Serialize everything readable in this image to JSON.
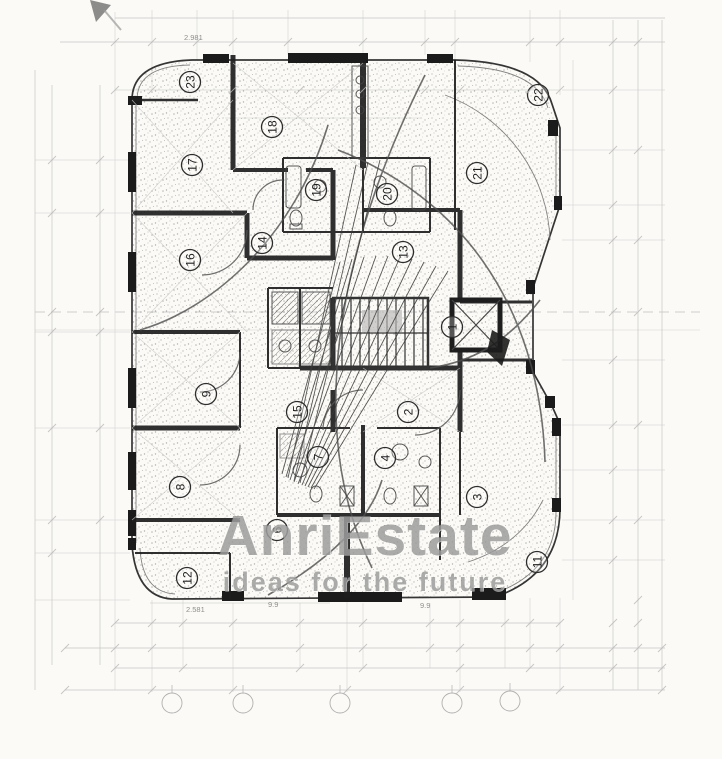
{
  "watermark": {
    "brand": "AnriEstate",
    "tagline": "ideas for the future"
  },
  "room_markers": [
    {
      "n": "1",
      "x": 452,
      "y": 327
    },
    {
      "n": "2",
      "x": 408,
      "y": 412
    },
    {
      "n": "3",
      "x": 477,
      "y": 497
    },
    {
      "n": "4",
      "x": 385,
      "y": 458
    },
    {
      "n": "6",
      "x": 277,
      "y": 530
    },
    {
      "n": "7",
      "x": 318,
      "y": 457
    },
    {
      "n": "8",
      "x": 180,
      "y": 487
    },
    {
      "n": "9",
      "x": 206,
      "y": 394
    },
    {
      "n": "11",
      "x": 537,
      "y": 562
    },
    {
      "n": "12",
      "x": 187,
      "y": 578
    },
    {
      "n": "13",
      "x": 403,
      "y": 252
    },
    {
      "n": "14",
      "x": 262,
      "y": 243
    },
    {
      "n": "15",
      "x": 297,
      "y": 412
    },
    {
      "n": "16",
      "x": 190,
      "y": 260
    },
    {
      "n": "17",
      "x": 192,
      "y": 165
    },
    {
      "n": "18",
      "x": 272,
      "y": 127
    },
    {
      "n": "19",
      "x": 316,
      "y": 190
    },
    {
      "n": "20",
      "x": 387,
      "y": 194
    },
    {
      "n": "21",
      "x": 477,
      "y": 173
    },
    {
      "n": "22",
      "x": 538,
      "y": 95
    },
    {
      "n": "23",
      "x": 190,
      "y": 82
    }
  ],
  "dimension_labels": [
    {
      "text": "2.981",
      "x": 184,
      "y": 40
    },
    {
      "text": "2.581",
      "x": 186,
      "y": 612
    },
    {
      "text": "9.9",
      "x": 268,
      "y": 607
    },
    {
      "text": "9.9",
      "x": 420,
      "y": 608
    }
  ],
  "axis_bubbles": [
    {
      "x": 172,
      "y": 703
    },
    {
      "x": 243,
      "y": 703
    },
    {
      "x": 340,
      "y": 703
    },
    {
      "x": 452,
      "y": 703
    },
    {
      "x": 510,
      "y": 701
    }
  ],
  "colors": {
    "paper": "#fbfaf6",
    "ink": "#1e1e1e",
    "faint_line": "#b8b8b8",
    "watermark_gray": "#585858",
    "stipple": "#6b6b6b"
  }
}
